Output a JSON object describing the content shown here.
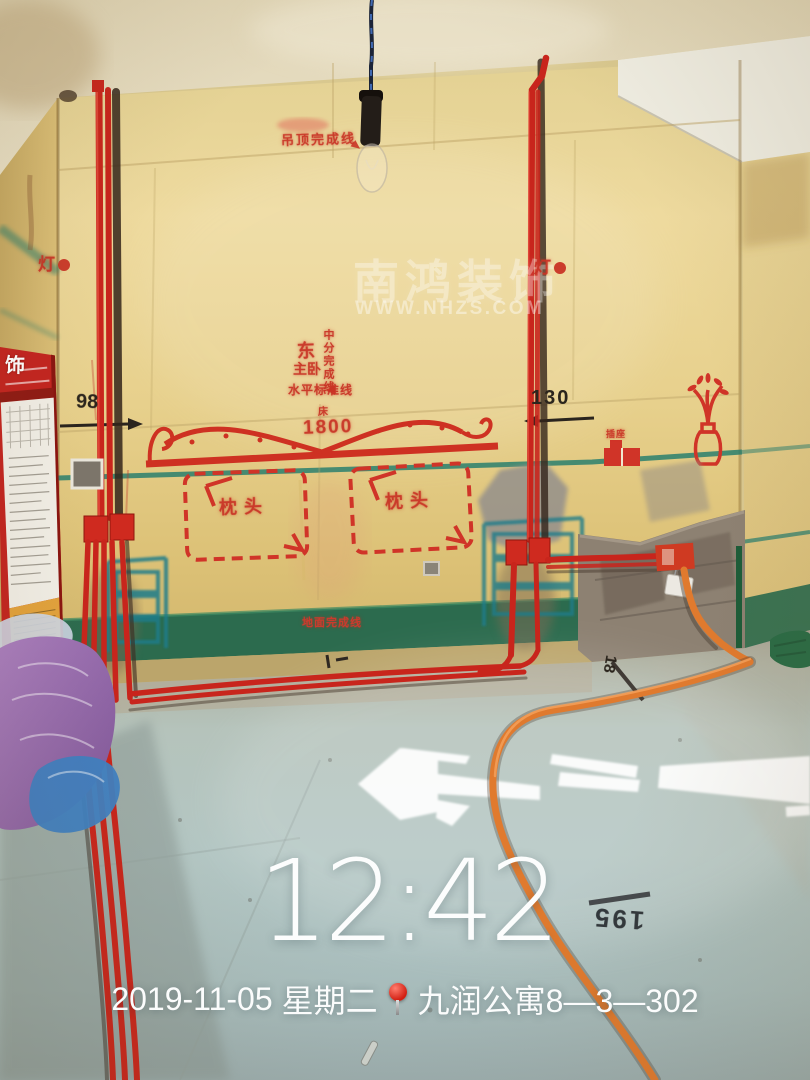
{
  "overlay": {
    "time": "12:42",
    "date": "2019-11-05",
    "weekday": "星期二",
    "location": "九润公寓8—3—302"
  },
  "watermark": {
    "brand": "南鸿装饰",
    "url": "WWW.NHZS.COM"
  },
  "markings": {
    "ceiling_line": "吊顶完成线",
    "lamp_left": "灯",
    "lamp_right": "灯",
    "center_split_line": "中分完成线",
    "east": "东",
    "master_bedroom": "主卧",
    "level_line": "水平标准线",
    "bed_label": "床",
    "bed_width": "1800",
    "pillow_left": "枕头",
    "pillow_right": "枕头",
    "socket_label": "插座",
    "floor_line": "地面完成线",
    "dim_left": "98",
    "dim_right": "130",
    "floor_dim_rotated": "195",
    "floor_dim_small": "18"
  },
  "poster": {
    "brand_char": "饰"
  },
  "colors": {
    "spray_red": "#c93325",
    "marker_black": "#2b251d",
    "teal_guideline": "#237c6d",
    "baseboard_green": "#2c6b4e",
    "conduit_red": "#c8251c",
    "conduit_orange": "#e07a2e",
    "wall_yellow": "#e7d28e",
    "overlay_text": "#ffffff"
  }
}
